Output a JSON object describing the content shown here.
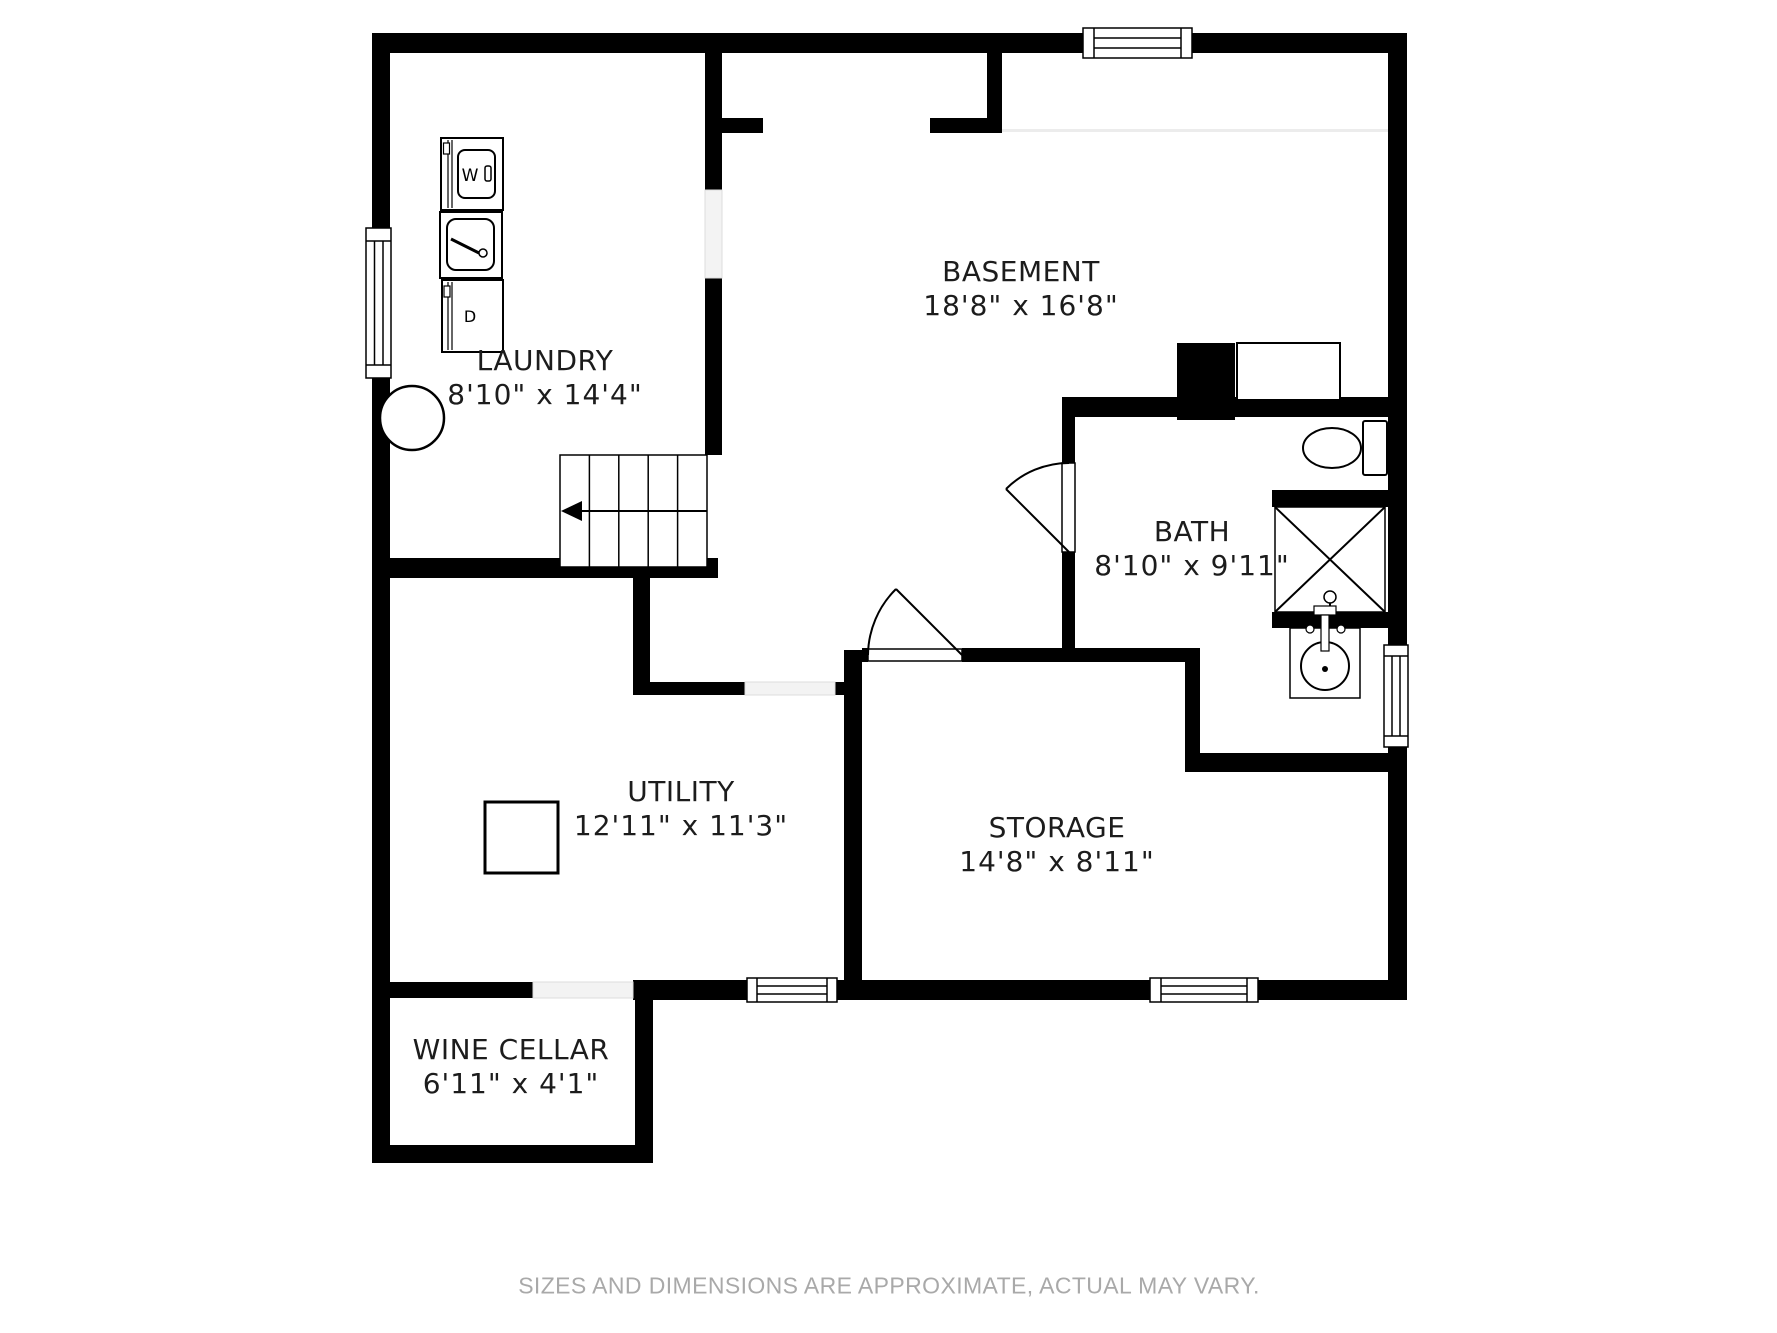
{
  "footer": {
    "disclaimer": "SIZES AND DIMENSIONS ARE APPROXIMATE, ACTUAL MAY VARY."
  },
  "colors": {
    "wall": "#000000",
    "floor": "#ffffff",
    "label_text": "#1c1c1c",
    "footer_text": "#a9a9a9",
    "opening_fill": "#f3f3f3"
  },
  "rooms": {
    "basement": {
      "name": "BASEMENT",
      "dims": "18'8\" x 16'8\""
    },
    "laundry": {
      "name": "LAUNDRY",
      "dims": "8'10\" x 14'4\""
    },
    "bath": {
      "name": "BATH",
      "dims": "8'10\" x 9'11\""
    },
    "utility": {
      "name": "UTILITY",
      "dims": "12'11\" x 11'3\""
    },
    "storage": {
      "name": "STORAGE",
      "dims": "14'8\" x 8'11\""
    },
    "wine_cellar": {
      "name": "WINE CELLAR",
      "dims": "6'11\" x 4'1\""
    }
  },
  "fixtures": {
    "washer": {
      "label": "W"
    },
    "dryer": {
      "label": "D"
    }
  }
}
